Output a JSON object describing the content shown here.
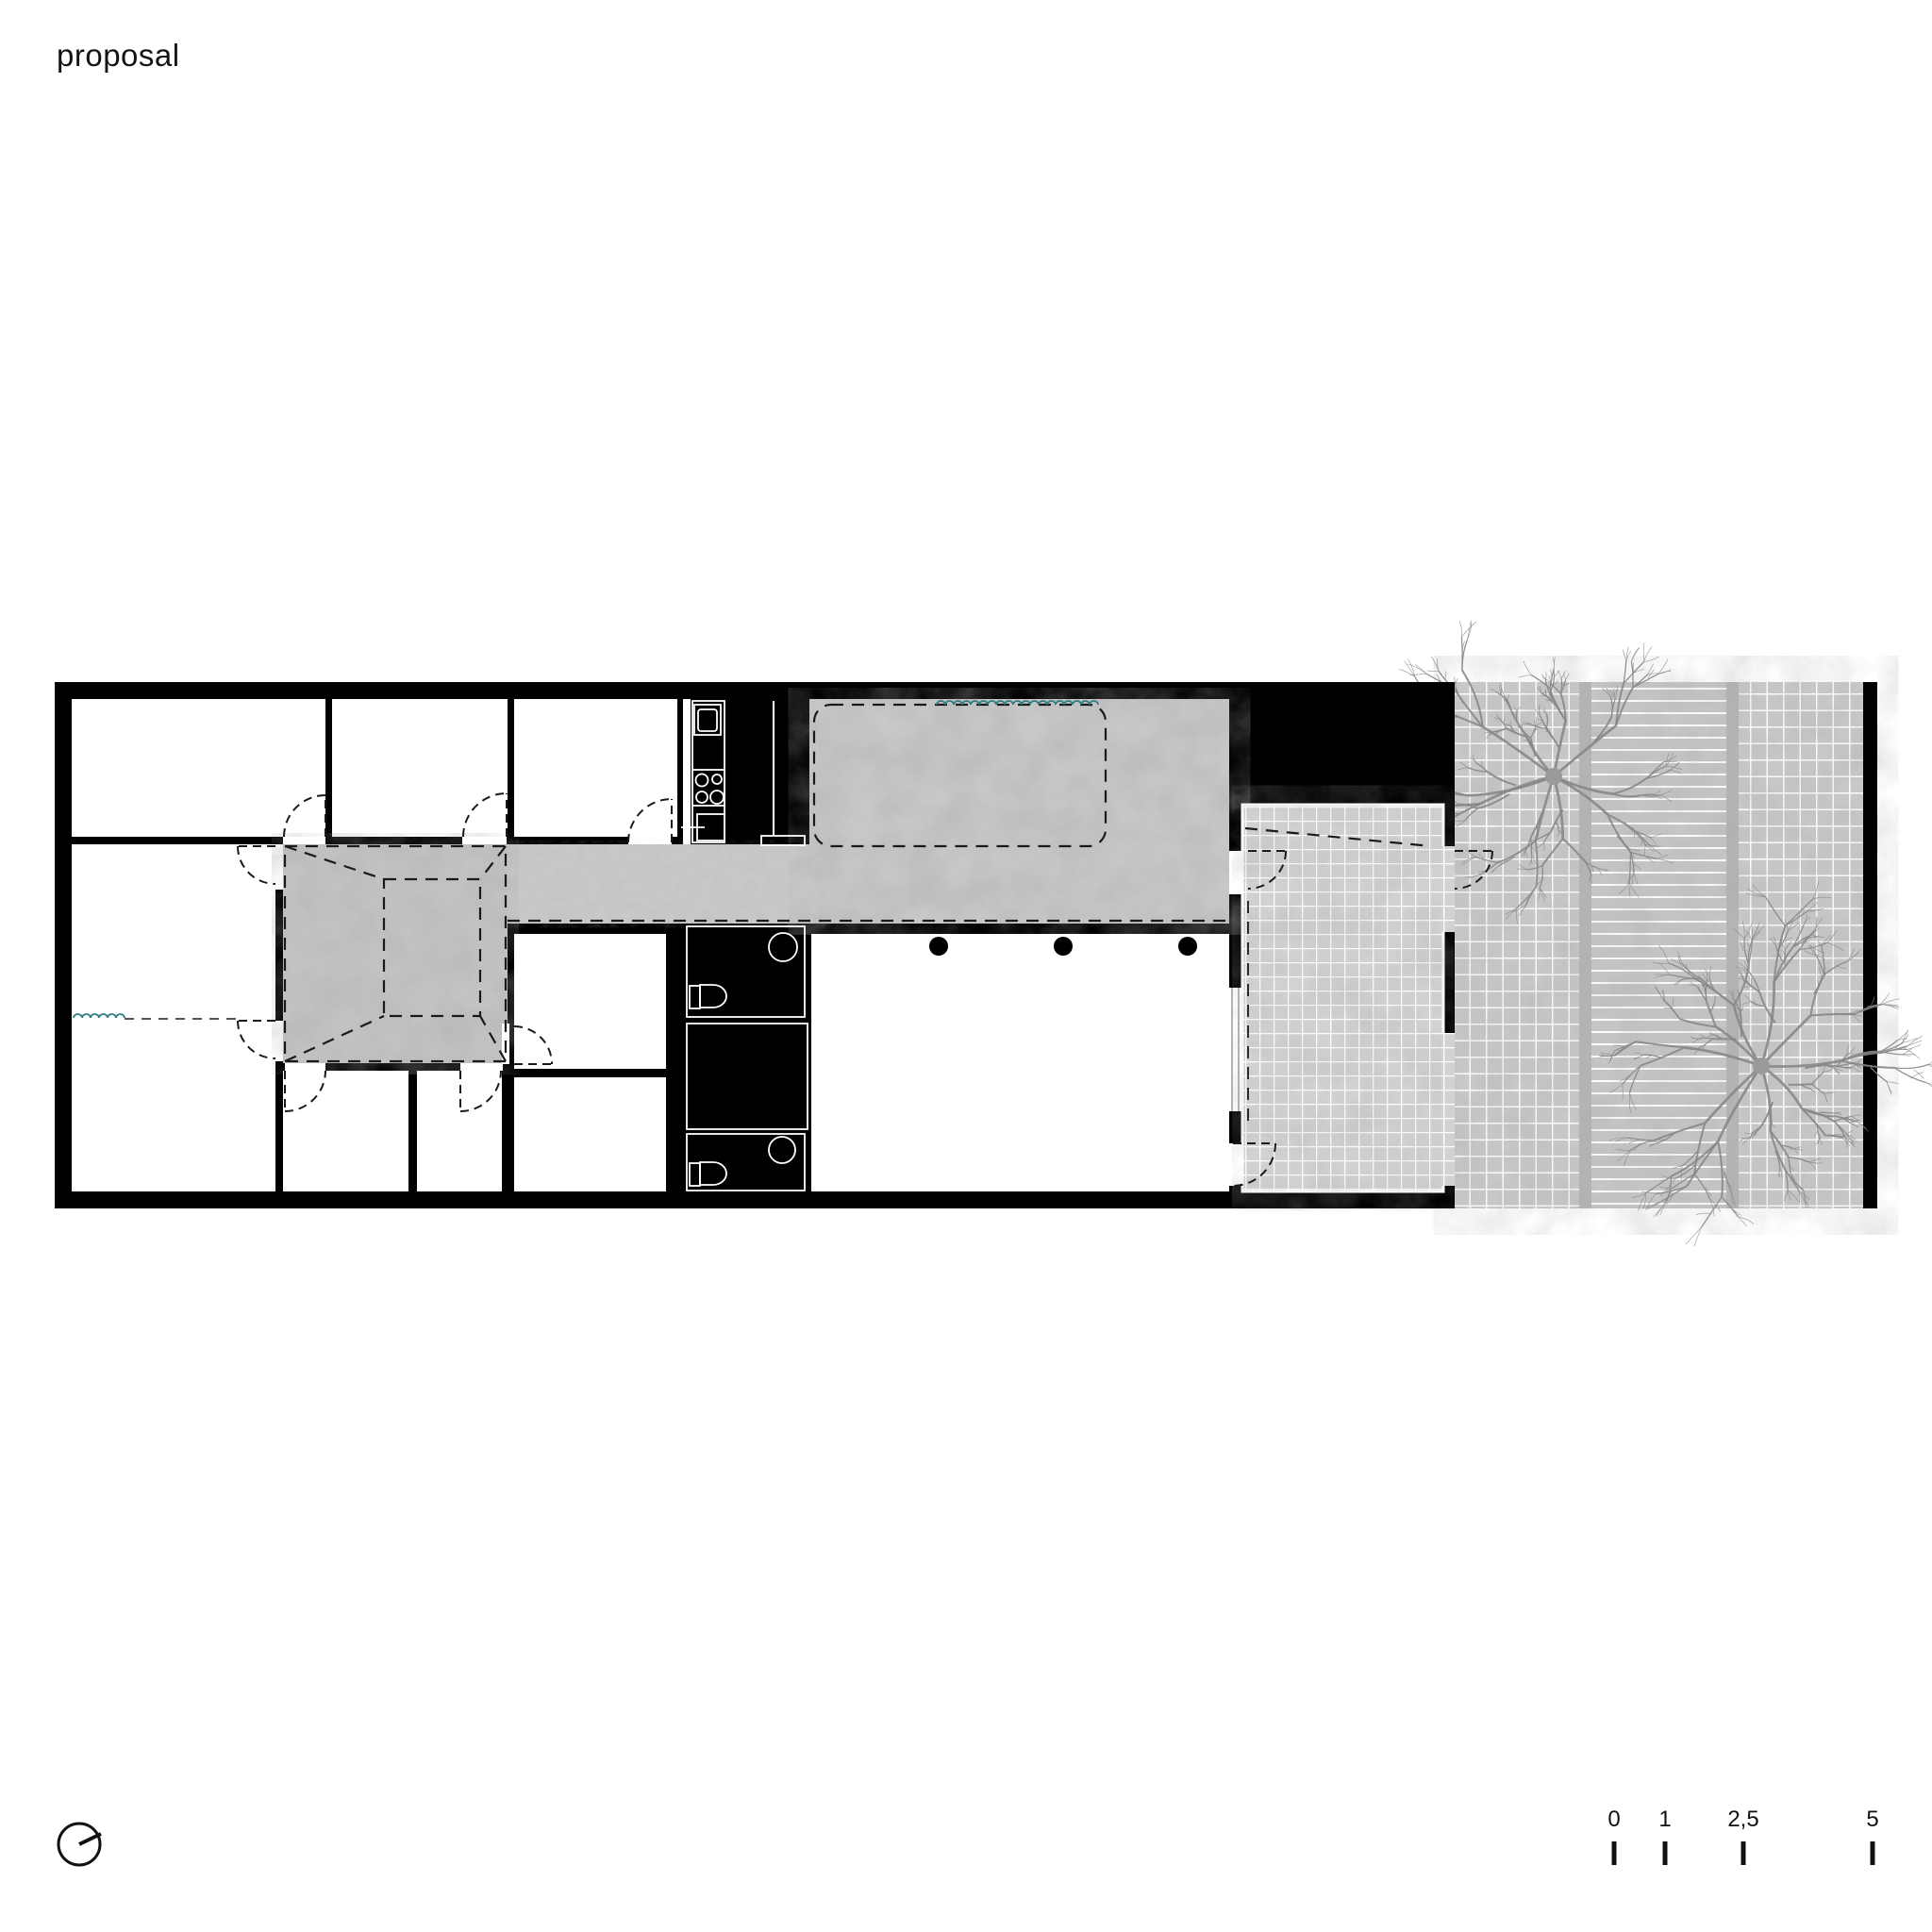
{
  "page": {
    "title": "proposal"
  },
  "drawing": {
    "kind": "single-storey floor plan with courtyard, patio and garden",
    "window_symbol": "teal-squiggle-icon",
    "column_symbol": "black-dot",
    "door_symbol": "dashed-quarter-arc"
  },
  "scale_bar": {
    "labels": [
      "0",
      "1",
      "2,5",
      "5"
    ]
  },
  "compass": {
    "icon": "north-arrow-icon"
  },
  "colors": {
    "paper": "#ffffff",
    "ink": "#000000",
    "concrete": "#c8c8c8",
    "courtyard_concrete": "#c4c4c4",
    "patio_tile": "#d2d2d2",
    "garden_tile": "#c9c9c9",
    "deck": "#c6c6c6",
    "tile_joint": "#ffffff",
    "teal_accent": "#2f7d80",
    "tree": "#878787"
  }
}
